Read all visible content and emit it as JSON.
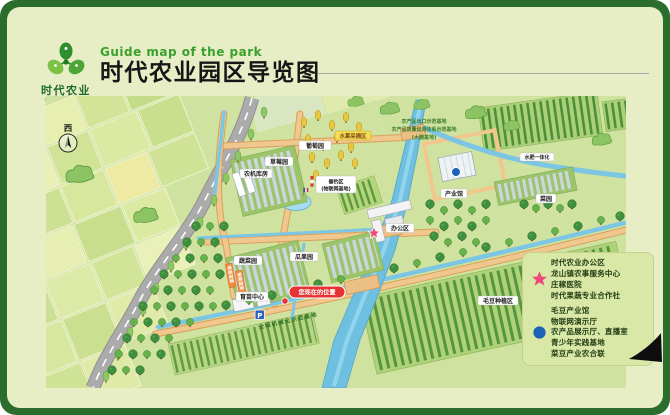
{
  "header": {
    "logo_cn": "时代农业",
    "logo_en": "TIME AGRICULTURE",
    "subtitle_en": "Guide map of the park",
    "title_cn": "时代农业园区导览图"
  },
  "map": {
    "compass": "西",
    "labels": {
      "grape_garden": "葡萄园",
      "strawberry_garden": "草莓园",
      "machinery_warehouse": "农机库房",
      "fruit_picking_area": "水果采摘区",
      "fishing_area": "垂钓区",
      "fishing_area_sub": "(物联网基地)",
      "vegetable_garden": "蔬菜园",
      "melon_garden": "瓜果园",
      "nursery_greenhouse": "育苗温室",
      "smart_greenhouse": "智能温室",
      "seedling_center": "育苗中心",
      "parking": "P",
      "you_are_here": "您现在的位置",
      "mechanization_base": "全程机械化示范基地",
      "vegetable_plot": "菜园",
      "soybean_area": "毛豆种植区",
      "industry_hall": "产业馆",
      "office_area": "办公区",
      "water_fertilizer": "水肥一体化",
      "demo_base_1": "农产品出口示范基地",
      "demo_base_2": "农产品质量追溯体系示范基地",
      "demo_base_3": "(大棚基地)"
    }
  },
  "legend": {
    "star_items": [
      "时代农业办公区",
      "龙山镇农事服务中心",
      "庄稼医院",
      "时代果蔬专业合作社"
    ],
    "dot_items": [
      "毛豆产业馆",
      "物联网演示厅",
      "农产品展示厅、直播室",
      "青少年实践基地",
      "菜豆产业农合联"
    ]
  },
  "colors": {
    "frame_green": "#2a6d2c",
    "sheet_cream": "#e7eec6",
    "map_base": "#cfe2a0",
    "accent_star": "#ee4a7c",
    "accent_dot": "#1b63b5",
    "title_green": "#3aa02c",
    "river_blue": "#6fc0e0",
    "path_orange": "#f0c78e"
  }
}
